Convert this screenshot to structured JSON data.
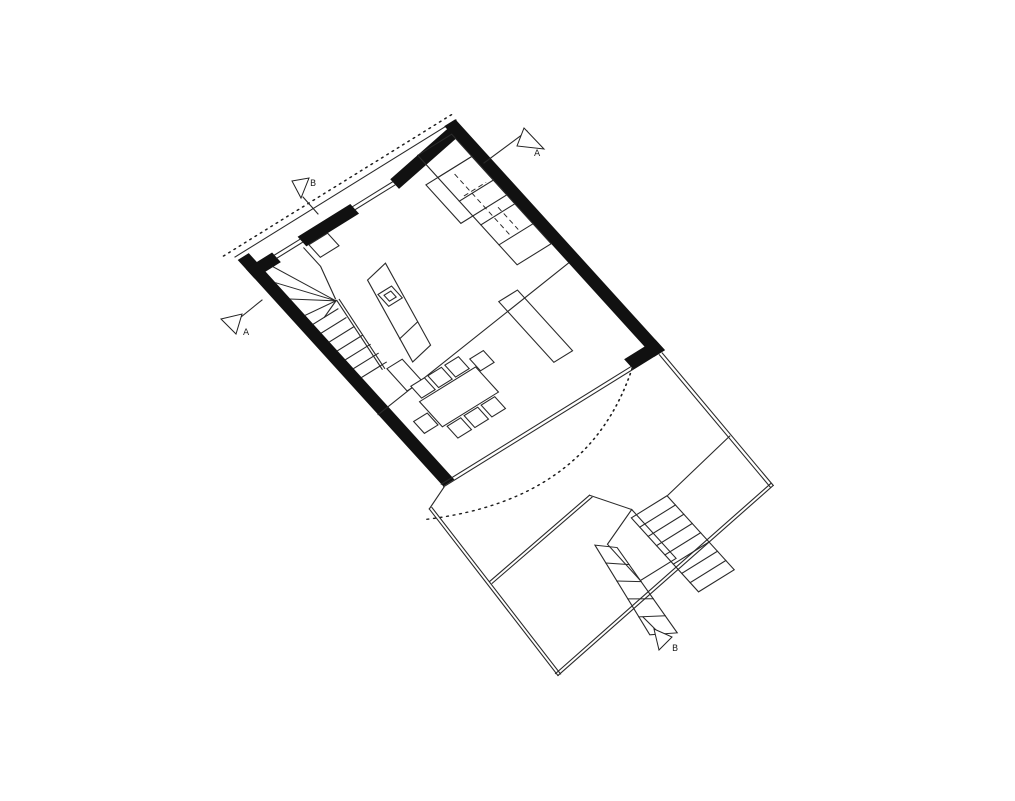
{
  "drawing": {
    "type": "architectural-floor-plan",
    "background_color": "#ffffff",
    "ink_color": "#1c1c1c",
    "wall_fill_color": "#111111",
    "section_markers": [
      {
        "id": "a-top",
        "label": "A"
      },
      {
        "id": "b-top",
        "label": "B"
      },
      {
        "id": "a-left",
        "label": "A"
      },
      {
        "id": "b-bottom",
        "label": "B"
      }
    ],
    "features": [
      "thick-masonry-walls",
      "roof-overhang-dotted-line",
      "facade-windows",
      "winder-staircase",
      "entry-closet",
      "kitchen-wall-counter",
      "kitchen-tall-unit",
      "kitchen-island",
      "cooktop",
      "dining-table",
      "dining-chairs-x8",
      "sideboard",
      "glazed-se-facade",
      "mezzanine-edge-line",
      "terrace-deck",
      "deck-edge",
      "exterior-stair-upper-flight",
      "exterior-stair-landing",
      "exterior-stair-lower-flight",
      "terrace-dotted-arc"
    ]
  }
}
